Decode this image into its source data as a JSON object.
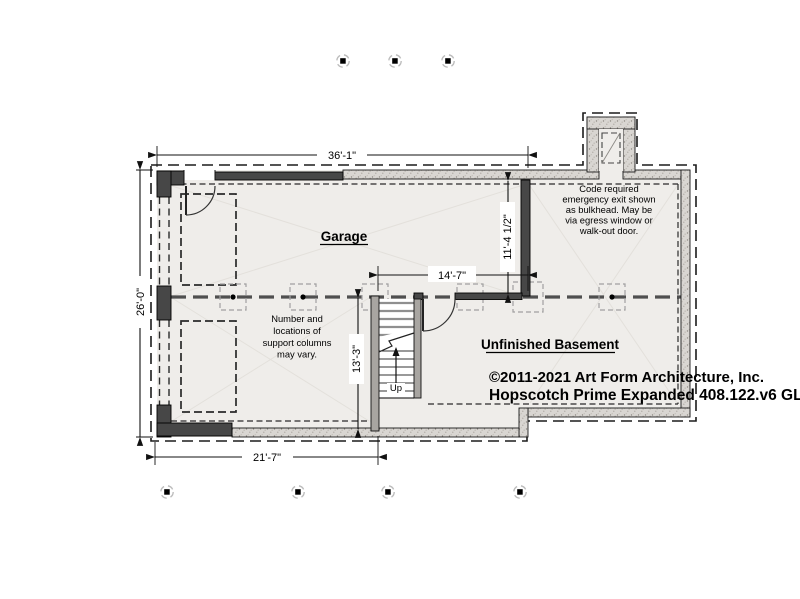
{
  "drawing": {
    "rooms": {
      "garage": "Garage",
      "basement": "Unfinished Basement"
    },
    "stair_label": "Up",
    "dimensions": {
      "top": "36'-1\"",
      "left": "26'-0\"",
      "bottom": "21'-7\"",
      "interior_width": "14'-7\"",
      "basement_depth": "11'-4 1/2\"",
      "stair_depth": "13'-3\""
    },
    "notes": {
      "columns": [
        "Number and",
        "locations of",
        "support columns",
        "may vary."
      ],
      "bulkhead": [
        "Code required",
        "emergency exit shown",
        "as bulkhead.  May be",
        "via  egress window or",
        "walk-out door."
      ]
    },
    "titleblock": {
      "copyright": "©2011-2021 Art Form Architecture, Inc.",
      "plan_name": "Hopscotch Prime Expanded 408.122.v6 GL"
    },
    "colors": {
      "wall_dark": "#474747",
      "wall_concrete": "#d9d6d2",
      "room_fill": "#efedea",
      "line": "#111111"
    }
  }
}
